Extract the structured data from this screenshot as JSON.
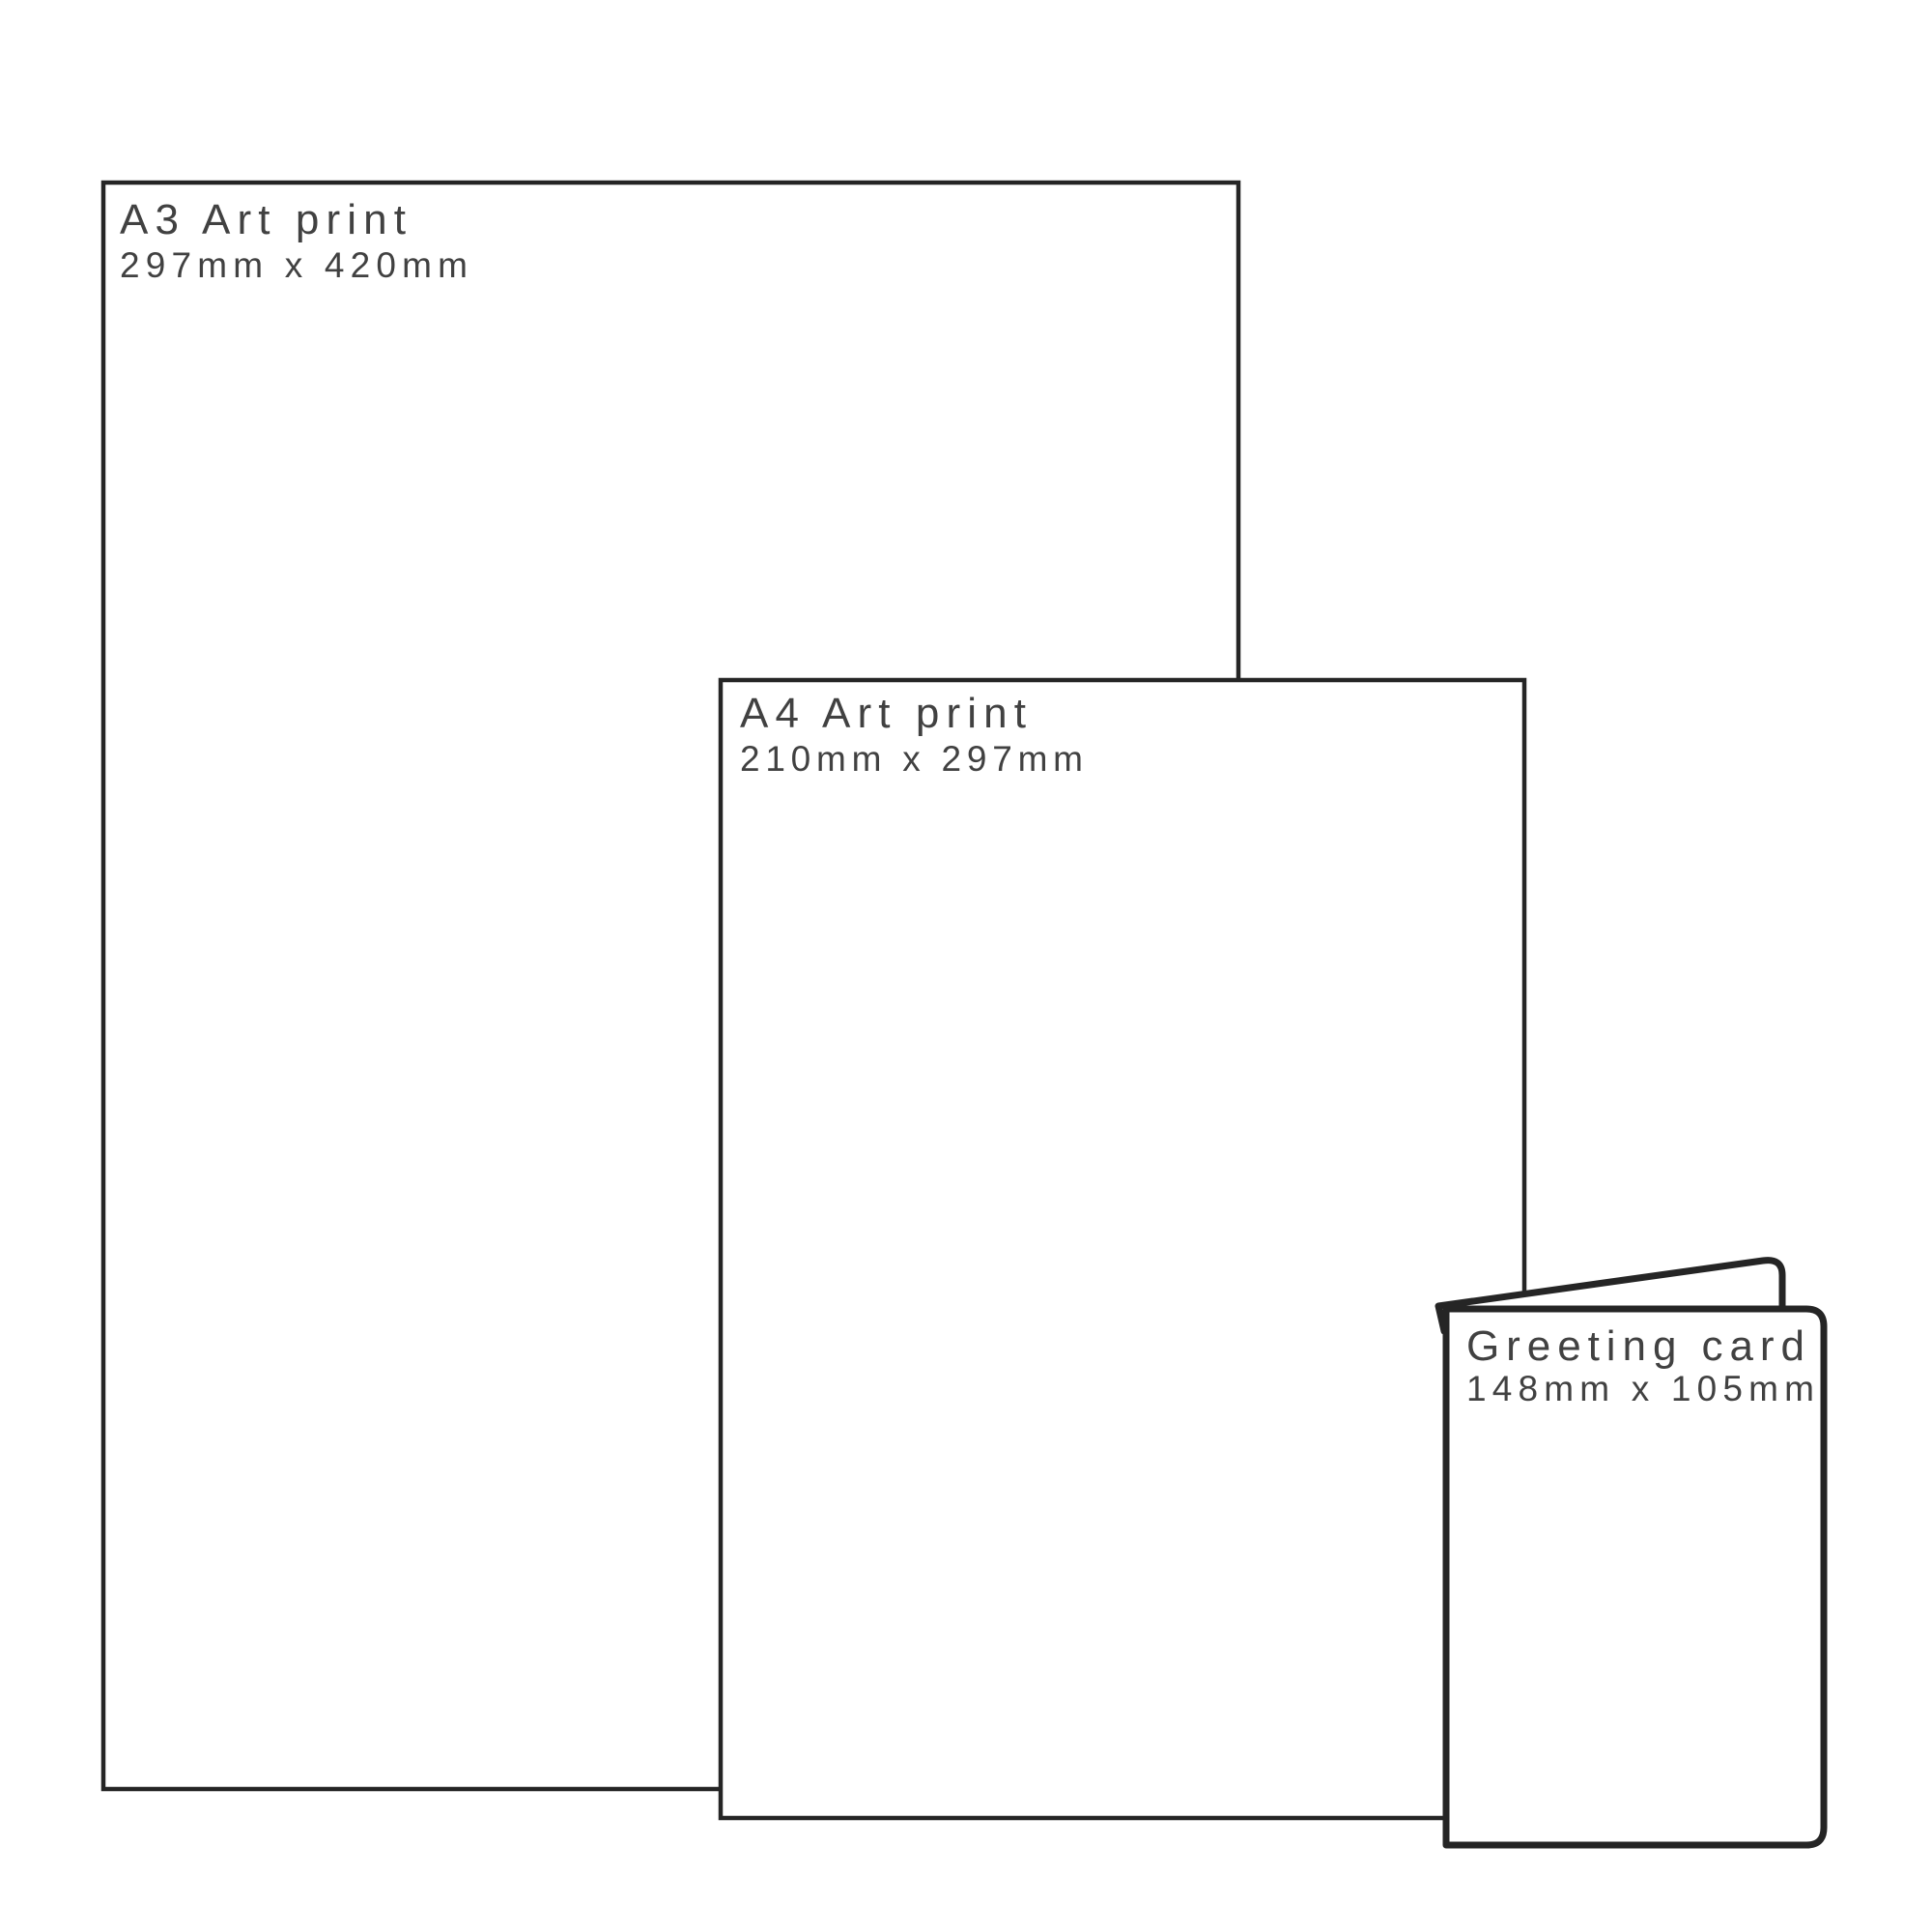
{
  "diagram": {
    "type": "size-comparison",
    "items": {
      "a3": {
        "label": "A3 Art print",
        "dimensions": "297mm x 420mm"
      },
      "a4": {
        "label": "A4 Art print",
        "dimensions": "210mm x 297mm"
      },
      "card": {
        "label": "Greeting card",
        "dimensions": "148mm x 105mm"
      }
    },
    "colors": {
      "background": "#ffffff",
      "outline": "#252525",
      "text": "#414141"
    }
  }
}
